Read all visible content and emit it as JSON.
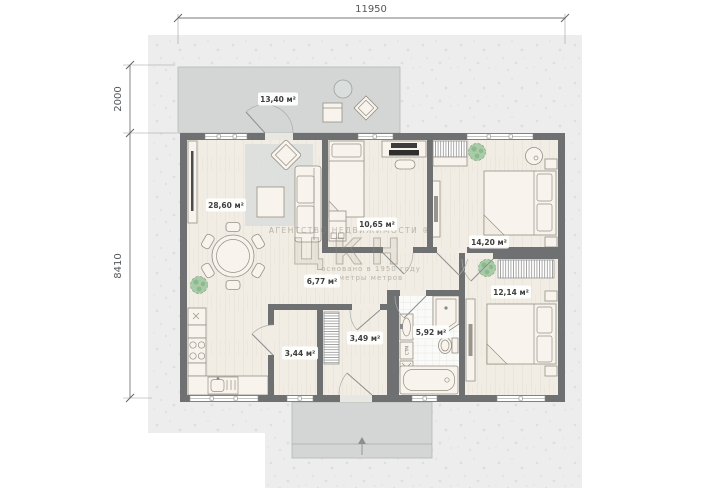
{
  "plan": {
    "dimensions": {
      "top": "11950",
      "side_upper": "2000",
      "side_lower": "8410"
    },
    "rooms": [
      {
        "name": "terrace",
        "area_label": "13,40 м²"
      },
      {
        "name": "living-kitchen",
        "area_label": "28,60 м²"
      },
      {
        "name": "bedroom-office",
        "area_label": "10,65 м²"
      },
      {
        "name": "bedroom-top-right",
        "area_label": "14,20 м²"
      },
      {
        "name": "bedroom-bottom-right",
        "area_label": "12,14 м²"
      },
      {
        "name": "hallway",
        "area_label": "6,77 м²"
      },
      {
        "name": "bathroom",
        "area_label": "5,92 м²"
      },
      {
        "name": "entry-hall",
        "area_label": "3,49 м²"
      },
      {
        "name": "storage",
        "area_label": "3,44 м²"
      }
    ],
    "appliances": {
      "washing_machine": "СТМ"
    },
    "watermark": {
      "line1": "АГЕНТСТВО НЕДВИЖИМОСТИ ®",
      "logo": "ЦКН",
      "line2": "основано в 1950 году",
      "line3": "метры метров"
    },
    "colors": {
      "wall": "#6e7071",
      "floor": "#f1ede4",
      "paved": "#d3d6d4",
      "lot": "#ecedec",
      "plant": "#a9cba9",
      "label-text": "#3e3e3e",
      "dim": "#54585a",
      "watermark": "#8d8579"
    }
  }
}
